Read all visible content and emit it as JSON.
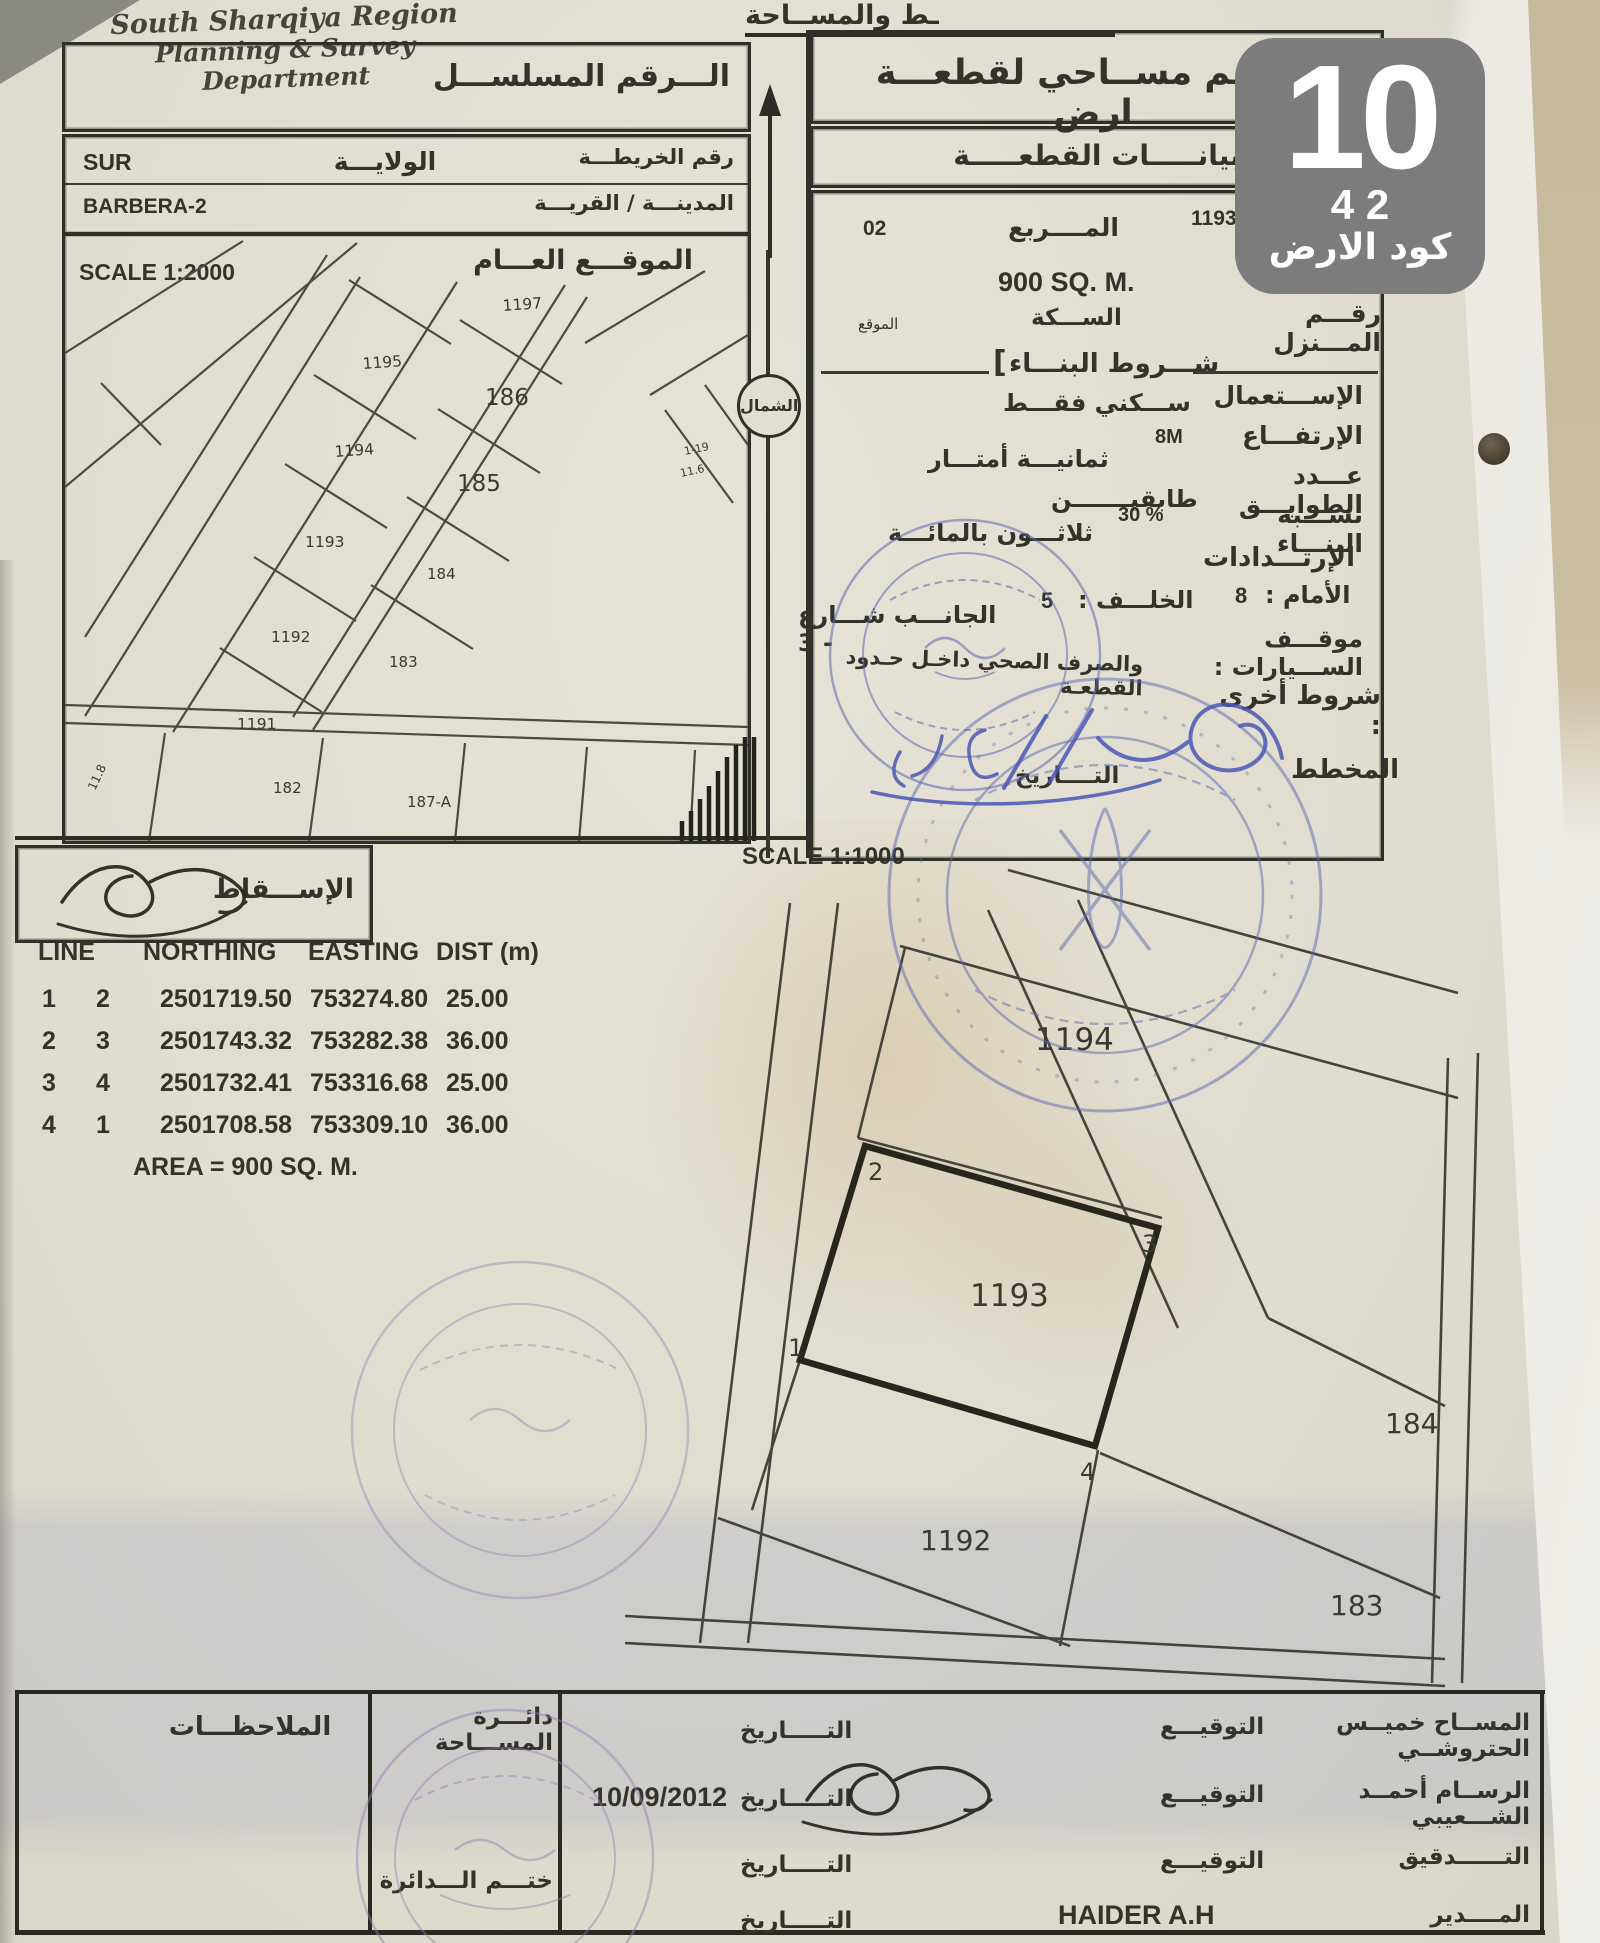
{
  "badge": {
    "number": "10",
    "sub": "4 2",
    "caption": "كود الارض"
  },
  "header": {
    "dept_en_line1": "South Sharqiya Region",
    "dept_en_line2": "Planning & Survey Department",
    "ministry_ar_partial": "ـط والمســاحة"
  },
  "left": {
    "serial_label": "الـــرقم المسلســـل",
    "wilaya_label": "الولايـــة",
    "wilaya_value": "SUR",
    "map_no_label": "رقم الخريطـــة",
    "city_label": "المدينـــة / القريـــة",
    "city_value": "BARBERA-2",
    "location_title": "الموقـــع العـــام",
    "location_scale": "SCALE 1:2000",
    "parcels": [
      "1197",
      "1195",
      "186",
      "1194",
      "185",
      "1193",
      "184",
      "1192",
      "183",
      "1191",
      "182",
      "187-A"
    ],
    "dims": [
      "11.8",
      "1-19",
      "11.6"
    ],
    "projection_label": "الإســـقاط"
  },
  "north": {
    "label": "الشمال"
  },
  "panel": {
    "title": "رســم مســاحي لقطعـــة ارض",
    "subtitle": "بيانـــــات القطعـــــة",
    "square_label": "المــــربع",
    "square_value": "02",
    "plot_value": "1193",
    "area_value": "900 SQ. M.",
    "street_label": "الســـكة",
    "street_note": "الموقع",
    "house_label": "رقـــم المـــنزل",
    "conditions_bracket": "[",
    "conditions_title": "شـــروط البنـــاء",
    "use_label": "الإســـتعمال",
    "use_value": "ســـكني فقـــط",
    "height_label": "الإرتفـــاع",
    "height_value": "8M",
    "height_value_ar": "ثمانيـــة أمتـــار",
    "floors_label": "عـــدد الطوابـــق",
    "floors_value": "طابقيـــــــن",
    "ratio_label": "نســـبة البنـــاء",
    "ratio_value": "30 %",
    "ratio_value_ar": "ثلاثـــون بالمائـــة",
    "setbacks_title": "الإرتـــدادات",
    "front_label": "الأمام :",
    "front_value": "8",
    "back_label": "الخلـــف :",
    "back_value": "5",
    "side_label": "الجانـــب شـــارع - 3",
    "parking_label": "موقـــف الســـيارات :",
    "other_label": "شروط أخرى :",
    "other_value": "والصرف الصحي داخـل حـدود القطعـة",
    "plan_label": "المخطط",
    "plan_date_label": "التــــاريخ"
  },
  "site_plan": {
    "scale": "SCALE 1:1000",
    "parcels": [
      "1194",
      "1193",
      "184",
      "1192",
      "183"
    ],
    "corners": [
      "1",
      "2",
      "3",
      "4"
    ]
  },
  "coords": {
    "headers": [
      "LINE",
      "NORTHING",
      "EASTING",
      "DIST (m)"
    ],
    "rows": [
      {
        "from": "1",
        "to": "2",
        "northing": "2501719.50",
        "easting": "753274.80",
        "dist": "25.00"
      },
      {
        "from": "2",
        "to": "3",
        "northing": "2501743.32",
        "easting": "753282.38",
        "dist": "36.00"
      },
      {
        "from": "3",
        "to": "4",
        "northing": "2501732.41",
        "easting": "753316.68",
        "dist": "25.00"
      },
      {
        "from": "4",
        "to": "1",
        "northing": "2501708.58",
        "easting": "753309.10",
        "dist": "36.00"
      }
    ],
    "area": "AREA = 900 SQ. M."
  },
  "footer": {
    "notes_label": "الملاحظـــات",
    "dept_label": "دائـــرة المســـاحة",
    "stamp_label": "ختـــم الـــدائرة",
    "rows": [
      {
        "role": "المســاح خميــس الحتروشــي",
        "sig_label": "التوقيـــع",
        "date_label": "التـــــاريخ",
        "date_value": ""
      },
      {
        "role": "الرســام أحمــد الشـــعيبي",
        "sig_label": "التوقيـــع",
        "date_label": "التـــــاريخ",
        "date_value": "10/09/2012"
      },
      {
        "role": "التــــــدقيق",
        "sig_label": "التوقيـــع",
        "date_label": "التـــــاريخ",
        "date_value": ""
      },
      {
        "role": "المــــدير",
        "sig_label": "HAIDER A.H",
        "date_label": "التـــــاريخ",
        "date_value": ""
      }
    ]
  },
  "stamps": {
    "blue_upper": "official-round-stamp-blue",
    "blue_lower": "official-round-stamp-blue-large",
    "purple_plan": "official-round-stamp-purple",
    "purple_footer": "department-seal-purple",
    "handwriting": "handwritten-blue-date-signature"
  }
}
